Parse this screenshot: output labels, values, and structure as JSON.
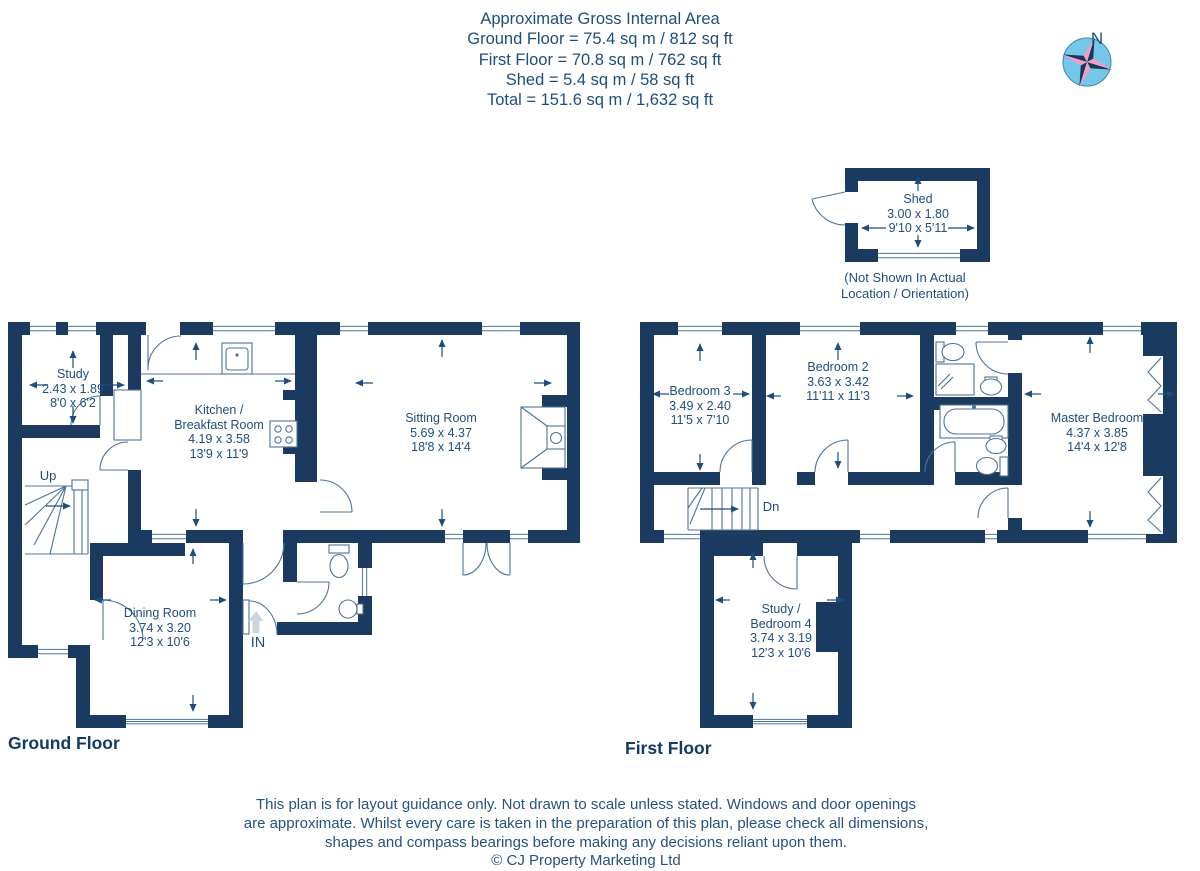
{
  "header": {
    "title": "Approximate Gross Internal Area",
    "area_lines": [
      "Ground Floor = 75.4 sq m / 812 sq ft",
      "First Floor = 70.8 sq m / 762 sq ft",
      "Shed = 5.4 sq m / 58 sq ft",
      "Total = 151.6 sq m / 1,632 sq ft"
    ]
  },
  "compass": {
    "label": "N"
  },
  "shed": {
    "name": "Shed",
    "metric": "3.00 x 1.80",
    "imperial": "9'10 x 5'11",
    "note_line1": "(Not Shown In Actual",
    "note_line2": "Location / Orientation)"
  },
  "ground_floor": {
    "title": "Ground Floor",
    "stairs_label": "Up",
    "entrance_label": "IN",
    "rooms": {
      "study": {
        "name": "Study",
        "metric": "2.43 x 1.89",
        "imperial": "8'0 x 6'2"
      },
      "kitchen": {
        "name_line1": "Kitchen /",
        "name_line2": "Breakfast Room",
        "metric": "4.19 x 3.58",
        "imperial": "13'9 x 11'9"
      },
      "sitting_room": {
        "name": "Sitting Room",
        "metric": "5.69 x 4.37",
        "imperial": "18'8 x 14'4"
      },
      "dining_room": {
        "name": "Dining Room",
        "metric": "3.74 x 3.20",
        "imperial": "12'3 x 10'6"
      }
    }
  },
  "first_floor": {
    "title": "First Floor",
    "stairs_label": "Dn",
    "rooms": {
      "bedroom_3": {
        "name": "Bedroom 3",
        "metric": "3.49 x 2.40",
        "imperial": "11'5 x 7'10"
      },
      "bedroom_2": {
        "name": "Bedroom 2",
        "metric": "3.63 x 3.42",
        "imperial": "11'11 x 11'3"
      },
      "master_bedroom": {
        "name": "Master Bedroom",
        "metric": "4.37 x 3.85",
        "imperial": "14'4 x 12'8"
      },
      "study_bedroom_4": {
        "name_line1": "Study /",
        "name_line2": "Bedroom 4",
        "metric": "3.74 x 3.19",
        "imperial": "12'3 x 10'6"
      }
    }
  },
  "footer": {
    "disclaimer_lines": [
      "This plan is for layout guidance only. Not drawn to scale unless stated. Windows and door openings",
      "are approximate. Whilst every care is taken in the preparation of this plan, please check all dimensions,",
      "shapes and compass bearings before making any decisions reliant upon them."
    ],
    "copyright": "© CJ Property Marketing Ltd"
  },
  "colors": {
    "wall": "#1a3a5f",
    "label_text": "#1e4e7d",
    "fixture_line": "#4d7498",
    "compass_blue": "#74c7e9",
    "compass_pink": "#f59cc4"
  }
}
